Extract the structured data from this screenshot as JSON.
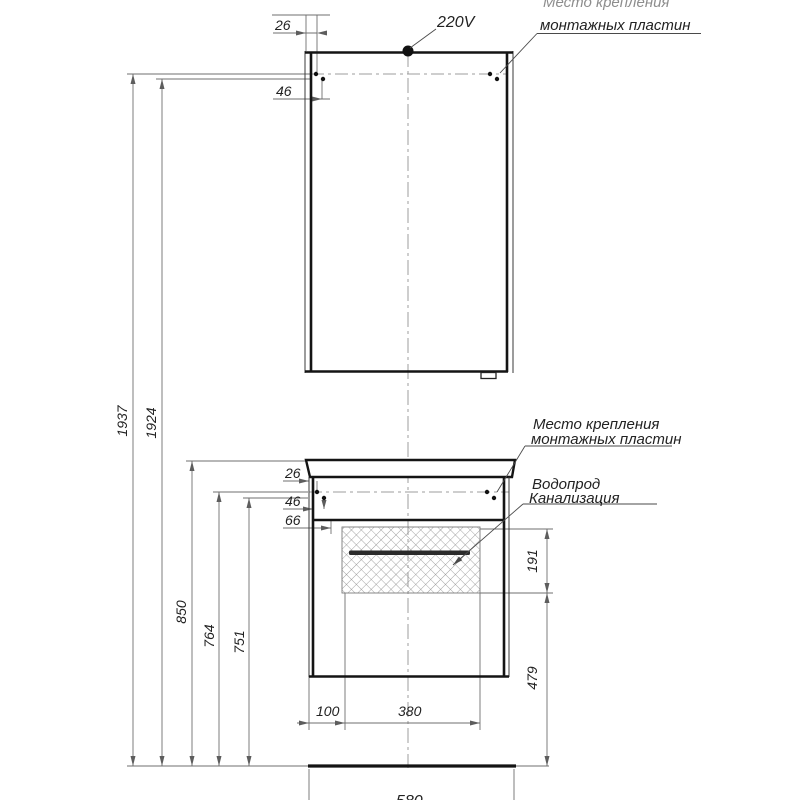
{
  "drawing": {
    "labels": {
      "power": "220V",
      "mount_top_line1": "Место крепления",
      "mount_top_line2": "монтажных пластин",
      "mount_mid_line1": "Место крепления",
      "mount_mid_line2": "монтажных пластин",
      "water_supply": "Водопрод",
      "sewerage": "Канализация"
    },
    "dimensions": {
      "mirror_mount_offset1": "26",
      "mirror_mount_offset2": "46",
      "total_height": "1937",
      "mirror_mount_height": "1924",
      "vanity_mount_offset1": "26",
      "vanity_mount_offset2": "46",
      "vanity_mount_offset3": "66",
      "vanity_top_height": "850",
      "vanity_mount_height1": "764",
      "vanity_mount_height2": "751",
      "opening_left_offset": "100",
      "opening_width": "380",
      "opening_height": "191",
      "opening_floor_height": "479",
      "vanity_width": "580"
    }
  }
}
